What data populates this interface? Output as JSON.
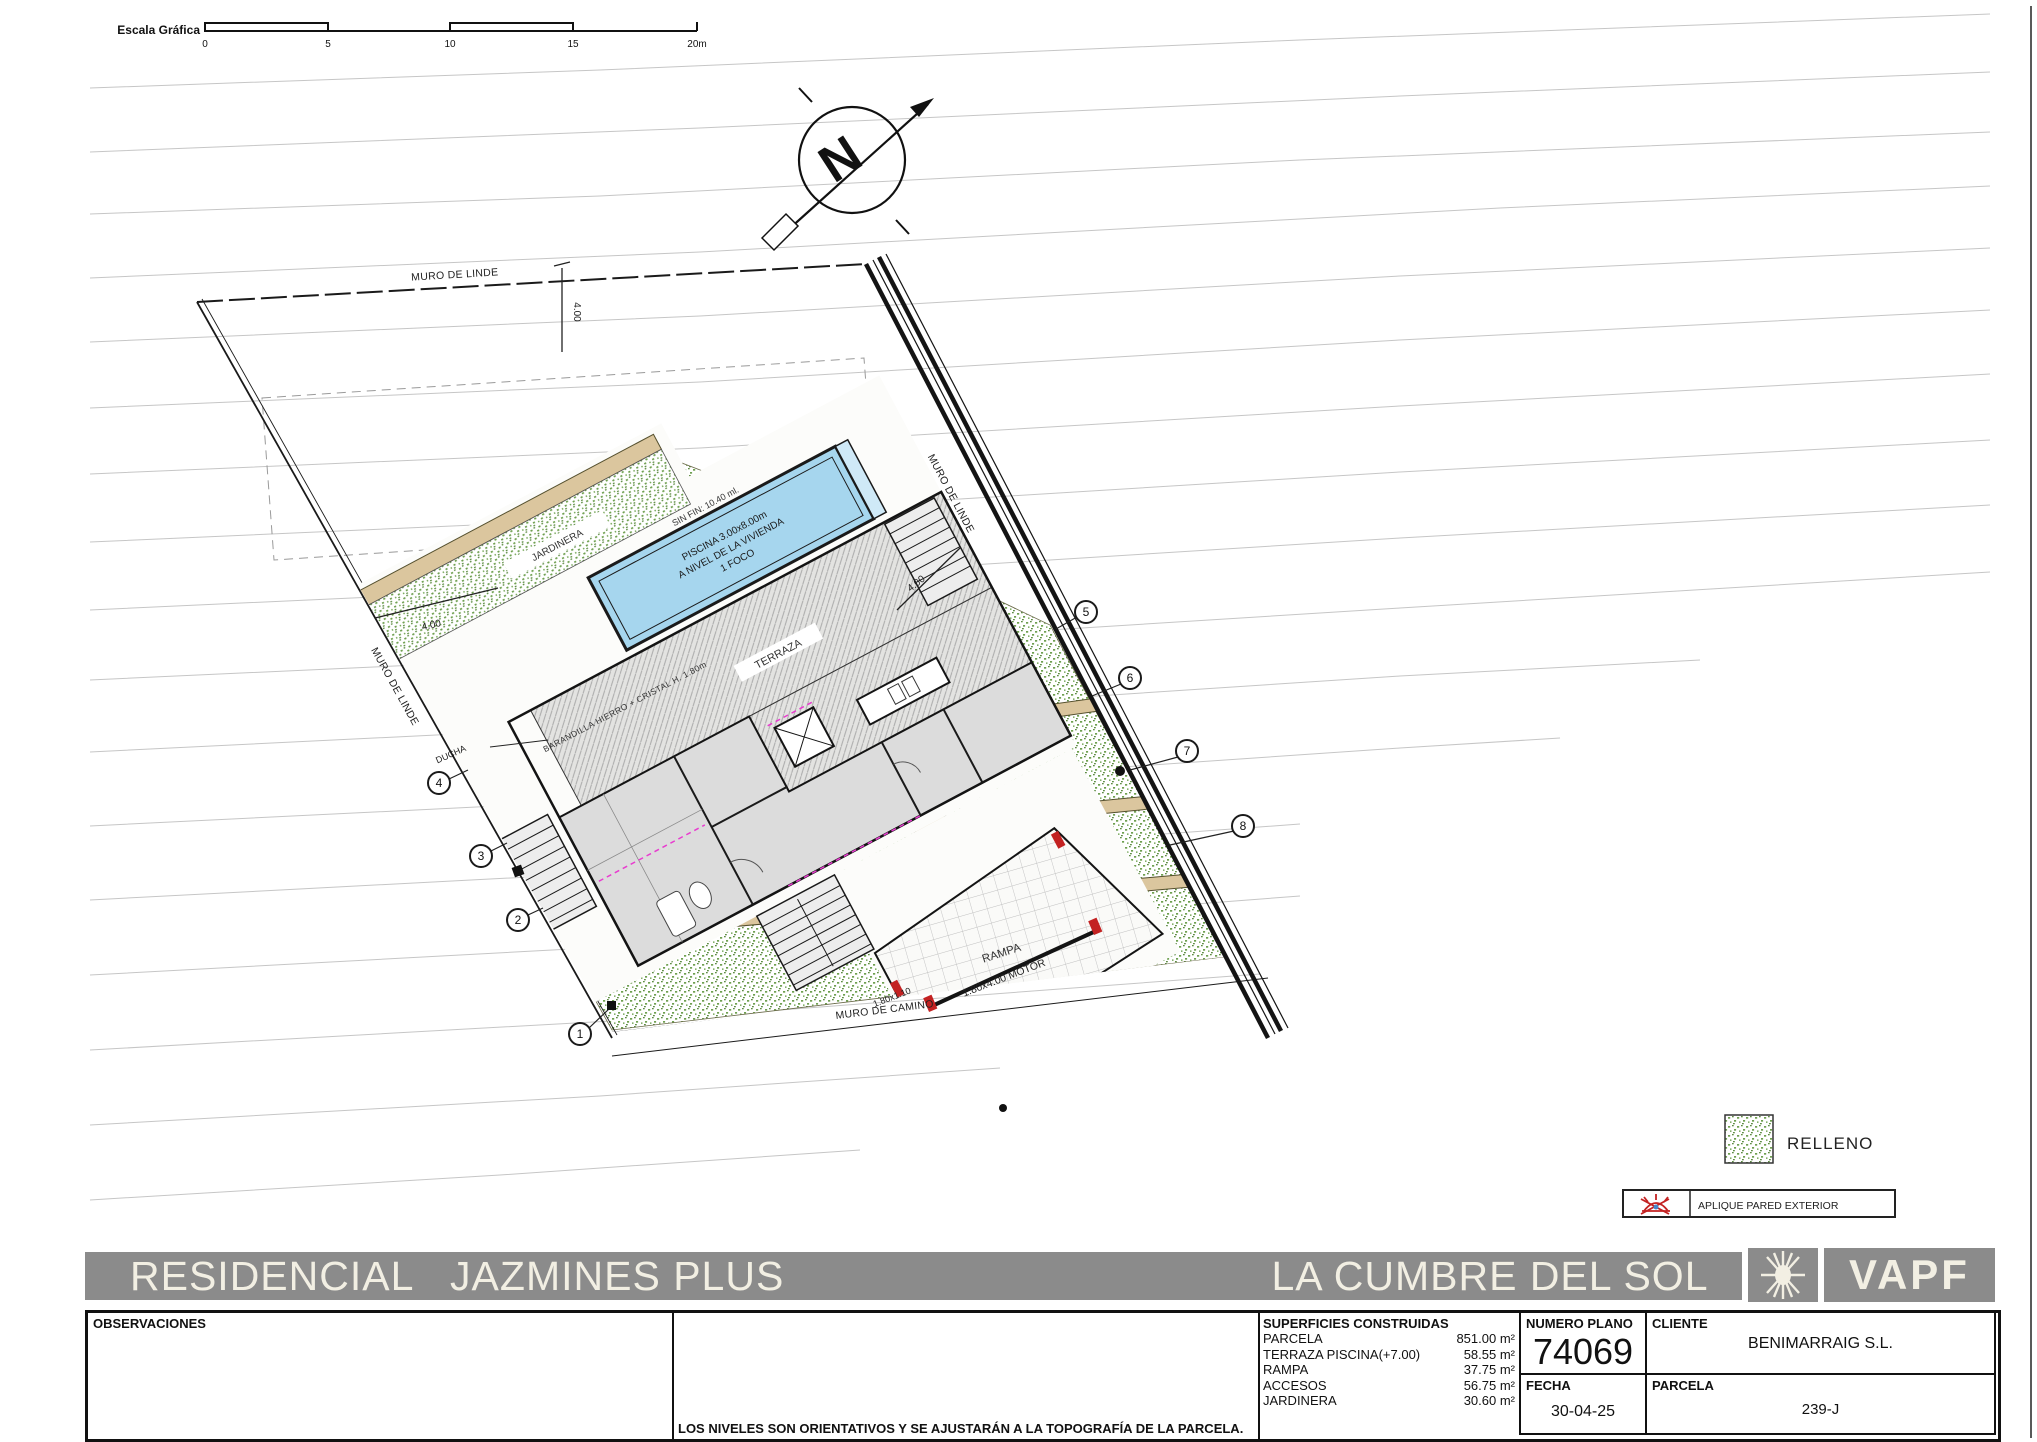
{
  "scale_bar": {
    "title": "Escala Gráfica",
    "ticks": [
      "0",
      "5",
      "10",
      "15",
      "20m"
    ]
  },
  "north": {
    "letter": "N"
  },
  "plan": {
    "labels": {
      "muro_linde": "MURO DE LINDE",
      "muro_camino": "MURO DE CAMINO",
      "jardinera": "JARDINERA",
      "ducha": "DUCHA",
      "terraza": "TERRAZA",
      "rampa": "RAMPA",
      "sin_fin": "SIN FIN: 10.40 ml.",
      "piscina_l1": "PISCINA 3.00x8.00m",
      "piscina_l2": "A NIVEL DE LA VIVIENDA",
      "piscina_l3": "1 FOCO",
      "barandilla": "BARANDILLA HIERRO + CRISTAL H. 1.80m",
      "motor": "1.80x4.00 MOTOR",
      "gate": "1.80x1.10",
      "dim": "4.00"
    },
    "markers_left": [
      "4",
      "3",
      "2",
      "1"
    ],
    "markers_right": [
      "5",
      "6",
      "7",
      "8"
    ]
  },
  "legend": {
    "relleno": "RELLENO",
    "aplique": "APLIQUE PARED EXTERIOR"
  },
  "title_bar": {
    "project": "RESIDENCIAL   JAZMINES PLUS",
    "resort": "LA CUMBRE DEL SOL",
    "brand": "VAPF"
  },
  "title_block": {
    "observaciones_label": "OBSERVACIONES",
    "note": "LOS NIVELES SON ORIENTATIVOS Y SE AJUSTARÁN A LA TOPOGRAFÍA DE LA PARCELA.",
    "superficies": {
      "header": "SUPERFICIES CONSTRUIDAS",
      "rows": [
        {
          "label": "PARCELA",
          "value": "851.00 m²"
        },
        {
          "label": "TERRAZA PISCINA(+7.00)",
          "value": "58.55 m²"
        },
        {
          "label": "RAMPA",
          "value": "37.75 m²"
        },
        {
          "label": "ACCESOS",
          "value": "56.75 m²"
        },
        {
          "label": "JARDINERA",
          "value": "30.60 m²"
        }
      ]
    },
    "numero_plano": {
      "label": "NUMERO PLANO",
      "value": "74069"
    },
    "fecha": {
      "label": "FECHA",
      "value": "30-04-25"
    },
    "cliente": {
      "label": "CLIENTE",
      "value": "BENIMARRAIG S.L."
    },
    "parcela": {
      "label": "PARCELA",
      "value": "239-J"
    }
  },
  "colors": {
    "pool_blue": "#a6d6ee",
    "relleno_green": "#6fa050",
    "wall_tan": "#dbc69e",
    "title_gray": "#8b8b8b",
    "accent_red": "#c32222",
    "magenta": "#e83ccf"
  }
}
